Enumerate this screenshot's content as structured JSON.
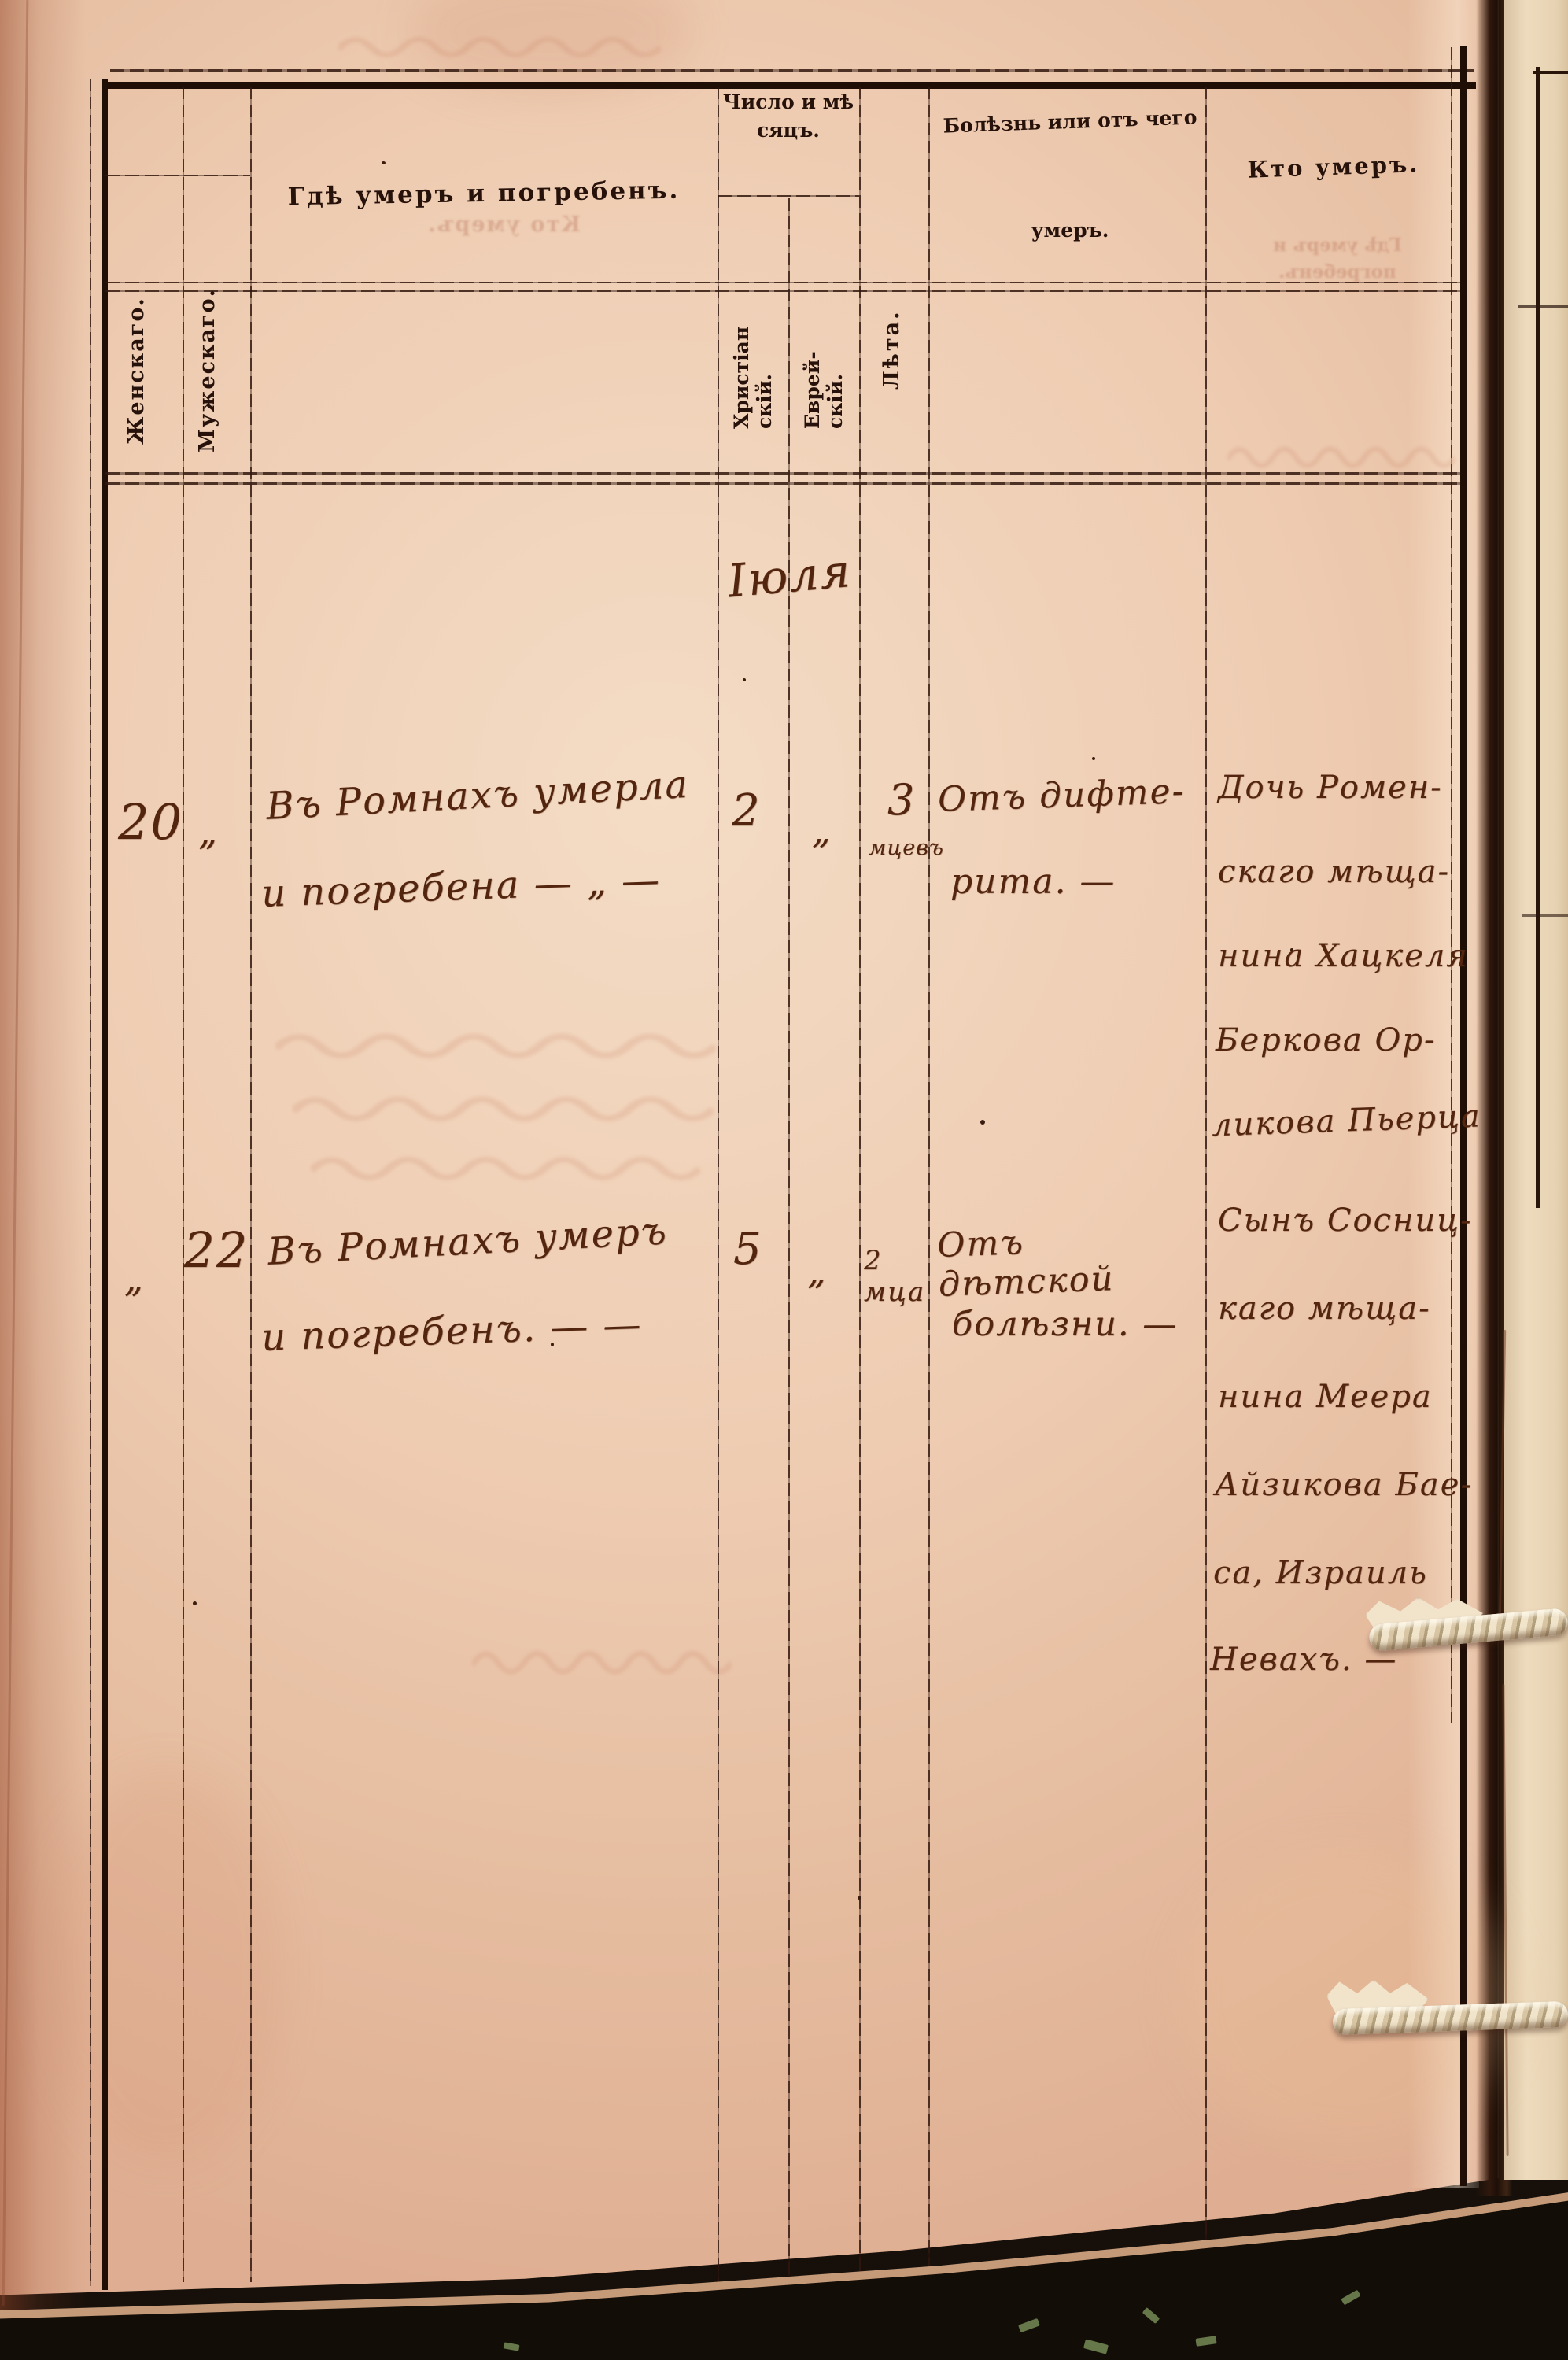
{
  "document": {
    "kind": "Scanned metrical book page — register of deaths",
    "language": "Russian, pre-reform orthography, handwritten entries"
  },
  "header": {
    "col_female": "Женскаго.",
    "col_male": "Мужескаго.",
    "col_where": "Гдѣ умеръ и погребенъ.",
    "col_date_group": "Число и мѣ\nсяцъ.",
    "col_date_christian": "Христіан\nскій.",
    "col_date_jewish": "Еврей-\nскій.",
    "col_age": "Лѣта.",
    "col_disease_line1": "Болѣзнь или отъ чего",
    "col_disease_line2": "умеръ.",
    "col_who": "Кто умеръ."
  },
  "body": {
    "month_header": "Іюля",
    "entries": [
      {
        "female_no": "20",
        "male_no": "„",
        "where": [
          "Въ Ромнахъ умерла",
          "и погребена — „ —"
        ],
        "date_christian": "2",
        "date_jewish": "„",
        "age_value": "3",
        "age_unit": "мцевъ",
        "cause": [
          "Отъ дифте-",
          "рита. —"
        ],
        "who": [
          "Дочь Ромен-",
          "скаго мѣща-",
          "нина Хацкеля",
          "Беркова Ор-",
          "ликова Пьерца"
        ]
      },
      {
        "female_no": "„",
        "male_no": "22",
        "where": [
          "Въ Ромнахъ умеръ",
          "и погребенъ. — —"
        ],
        "date_christian": "5",
        "date_jewish": "„",
        "age_value": "2 мца",
        "age_unit": "",
        "cause": [
          "Отъ дѣтской",
          "болѣзни. —"
        ],
        "who": [
          "Сынъ Сосниц-",
          "каго мѣща-",
          "нина Меера",
          "Айзикова Бае-",
          "са, Израиль",
          "Невахъ. —"
        ]
      }
    ]
  },
  "ghosts": {
    "header_col3": "Кто умеръ.",
    "header_col7": "Гдѣ умеръ и погребенъ."
  }
}
